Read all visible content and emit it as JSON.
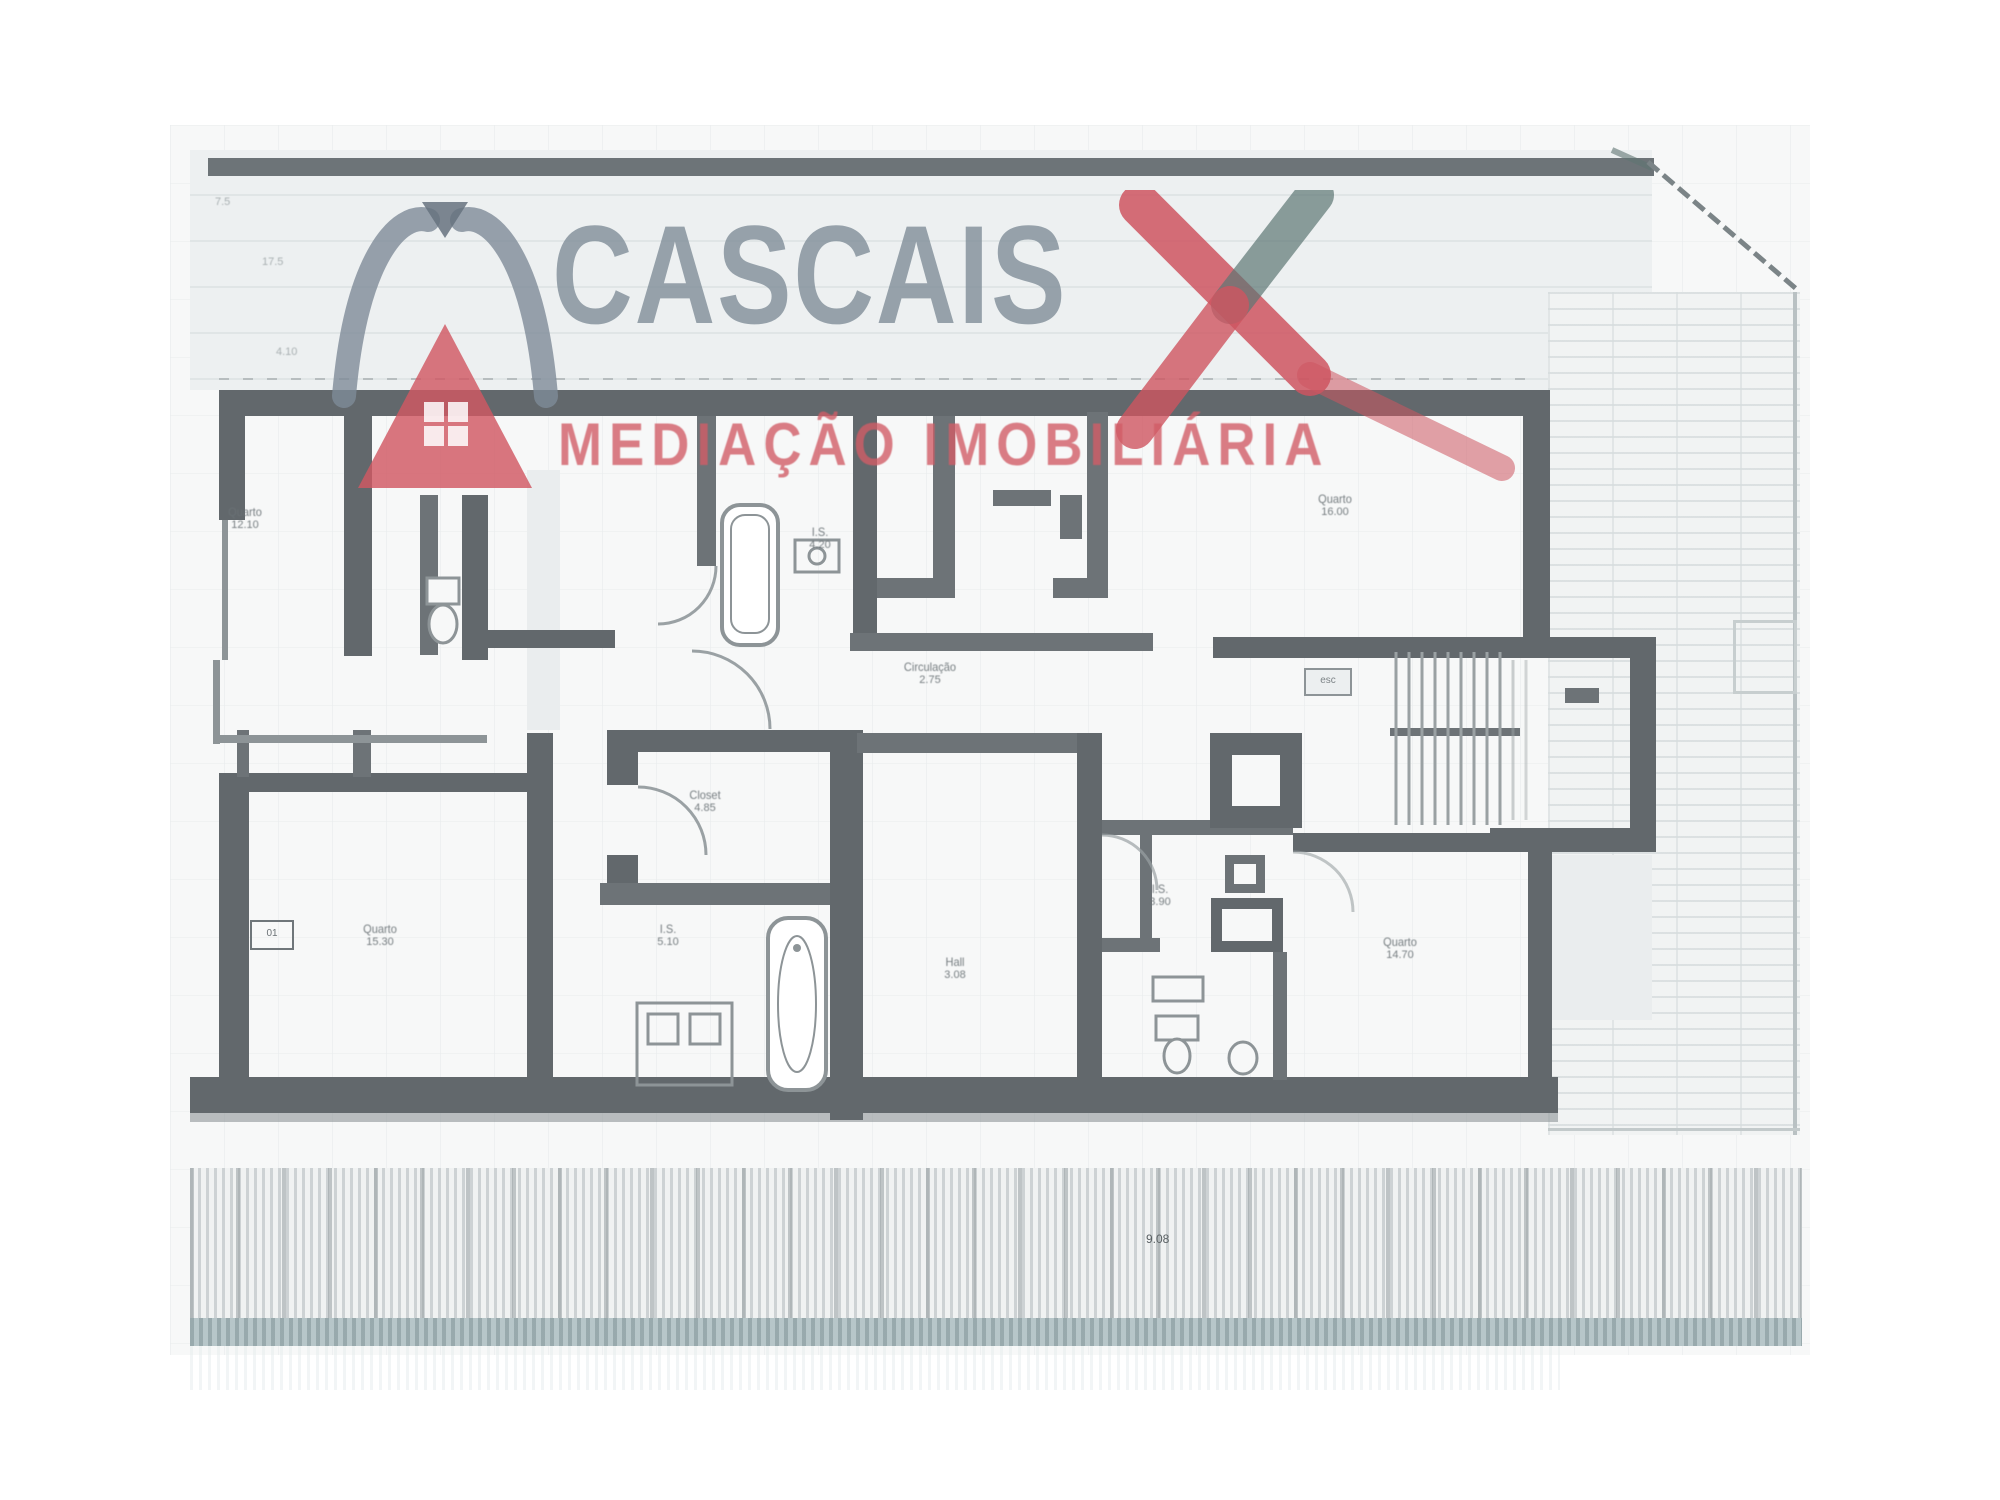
{
  "watermark": {
    "brand": "CASCAIS",
    "tagline": "MEDIAÇÃO IMOBILIÁRIA",
    "colors": {
      "brand_gray": "#808d99",
      "roof_red": "#d15863",
      "tagline_red": "#d15c67",
      "x_teal": "#5d7673"
    }
  },
  "plan": {
    "colors": {
      "wall": "#62686c",
      "fixture": "#8d9497",
      "paper": "#f7f8f8",
      "teal_band": "#b7c6c9"
    },
    "labels": {
      "room_top_left": {
        "name": "Quarto",
        "area": "12.10"
      },
      "bath_top": {
        "name": "I.S.",
        "area": "4.20"
      },
      "room_top_right": {
        "name": "Quarto",
        "area": "16.00"
      },
      "circulation": {
        "name": "Circulação",
        "area": "9.75",
        "dim": "2.75"
      },
      "closet": {
        "name": "Closet",
        "area": "4.85"
      },
      "room_bottom_left": {
        "name": "Quarto",
        "area": "15.30",
        "tag": "01"
      },
      "bath_bottom_left": {
        "name": "I.S.",
        "area": "5.10"
      },
      "hall_center": {
        "name": "Hall",
        "area": "3.08"
      },
      "bath_center": {
        "name": "I.S.",
        "area": "3.90"
      },
      "room_bottom_right": {
        "name": "Quarto",
        "area": "14.70"
      },
      "stairs_tag": "esc",
      "level_mark": "9.08",
      "dim_top": "17.5",
      "dim_left": "4.10",
      "dim_corner": "7.5"
    }
  }
}
